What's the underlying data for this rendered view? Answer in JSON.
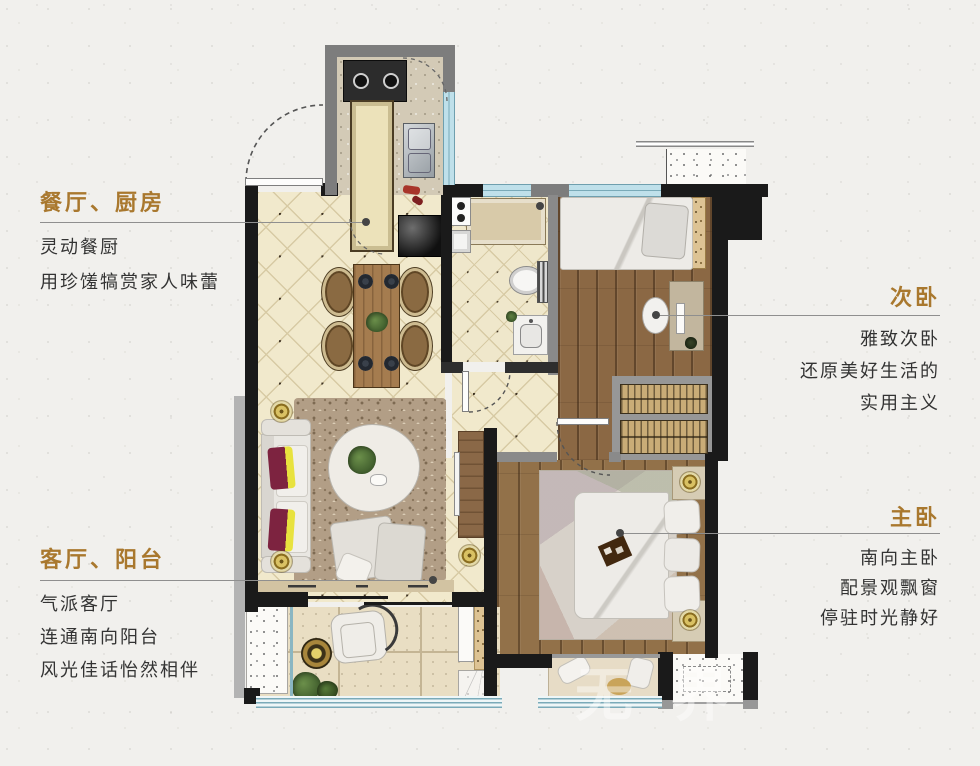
{
  "page": {
    "watermark": "无界"
  },
  "colors": {
    "accent": "#a9782e",
    "body_text": "#333333",
    "wall": "#1a1a1a",
    "window": "#7aaab8",
    "tile_floor": "#f1e9cc",
    "wood_floor": "#8b6844",
    "paper": "#f1f0ed"
  },
  "annotations": {
    "dining_kitchen": {
      "title": "餐厅、厨房",
      "lines": [
        "灵动餐厨",
        "用珍馐犒赏家人味蕾"
      ]
    },
    "living_balcony": {
      "title": "客厅、阳台",
      "lines": [
        "气派客厅",
        "连通南向阳台",
        "风光佳话怡然相伴"
      ]
    },
    "second_bedroom": {
      "title": "次卧",
      "lines": [
        "雅致次卧",
        "还原美好生活的",
        "实用主义"
      ]
    },
    "master_bedroom": {
      "title": "主卧",
      "lines": [
        "南向主卧",
        "配景观飘窗",
        "停驻时光静好"
      ]
    }
  }
}
